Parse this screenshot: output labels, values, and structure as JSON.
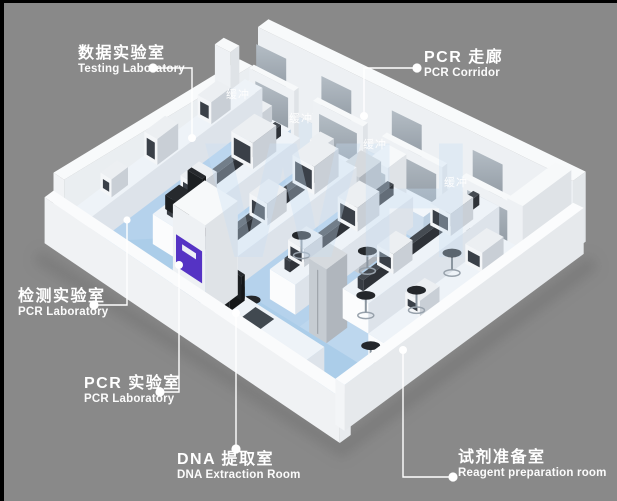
{
  "scene": {
    "watermark": "WH",
    "colors": {
      "background": "#898989",
      "frame": "#000000",
      "floor": "#b5d2ec",
      "corridor_floor": "#dde7f0",
      "wall": "#f1f3f5",
      "glass_light": "#b4bdc5",
      "glass_dark": "#8f98a1",
      "accent_purple": "#5533c4",
      "bench_front": "#cfdeed",
      "dark_shelf": "#383d44",
      "stool": "#24272b",
      "watermark_color": "#c9e0f5"
    }
  },
  "buffer_labels": [
    {
      "text": "缓冲"
    },
    {
      "text": "缓冲"
    },
    {
      "text": "缓冲"
    },
    {
      "text": "缓冲"
    }
  ],
  "callouts": {
    "testing": {
      "zh": "数据实验室",
      "en": "Testing Laboratory"
    },
    "corridor": {
      "zh": "PCR 走廊",
      "en": "PCR Corridor"
    },
    "detection": {
      "zh": "检测实验室",
      "en": "PCR Laboratory"
    },
    "pcr": {
      "zh": "PCR 实验室",
      "en": "PCR Laboratory"
    },
    "dna": {
      "zh": "DNA 提取室",
      "en": "DNA Extraction Room"
    },
    "reagent": {
      "zh": "试剂准备室",
      "en": "Reagent preparation room"
    }
  }
}
